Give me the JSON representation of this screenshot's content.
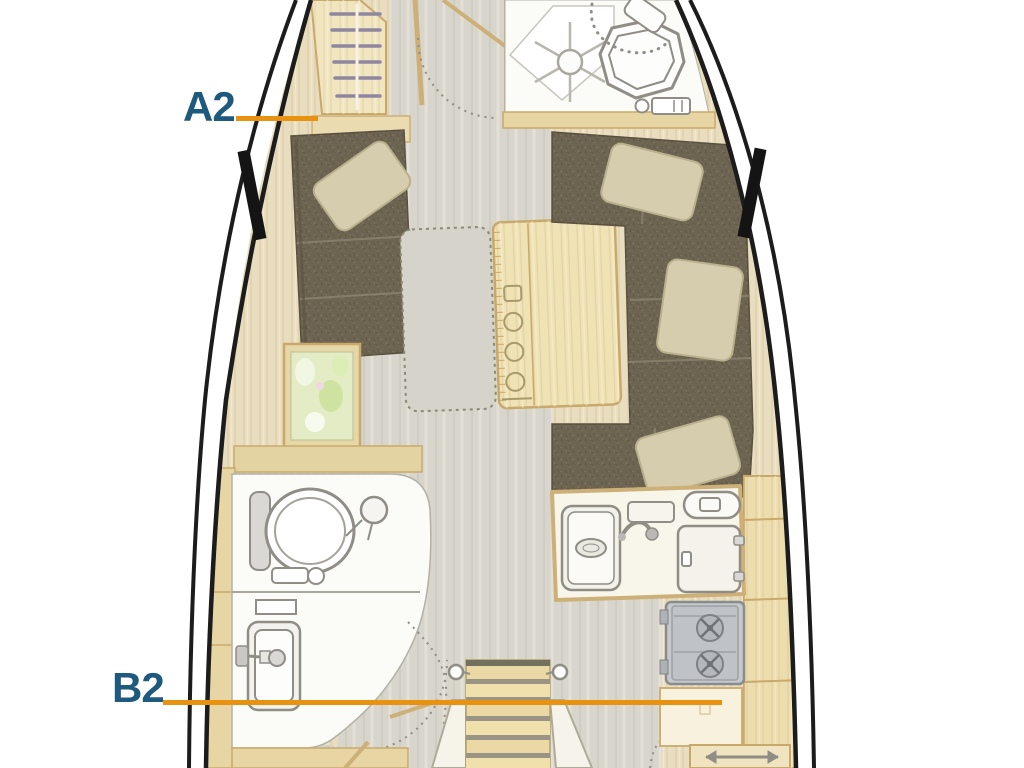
{
  "plan": {
    "type": "sailing-yacht-interior-floorplan",
    "callouts": [
      {
        "id": "a2",
        "label": "A2"
      },
      {
        "id": "b2",
        "label": "B2"
      }
    ],
    "legend_icons": [
      "wardrobe-hangers-icon",
      "shower-icon",
      "toilet-icon",
      "washbasin-icon",
      "saloon-table-icon",
      "settee-icon",
      "pillow-icon",
      "chart-table-icon",
      "galley-sink-icon",
      "fridge-icon",
      "stove-icon",
      "companionway-stairs-icon",
      "door-swing-arc-icon",
      "drawer-slide-arrow-icon"
    ]
  },
  "colors": {
    "label_blue": "#1e5a7e",
    "callout_orange": "#e8920f",
    "hull_black": "#1c1c1c",
    "deck_beige": "#e8ddbe",
    "wood_light": "#f1e5c0",
    "wood_border": "#c9a96b",
    "settee_brown": "#6e6452",
    "pillow_khaki": "#d5cdad",
    "floor_gray": "#d8d5cc",
    "room_white": "#fbfbf8",
    "fixture_gray": "#8f8d86",
    "stove_gray": "#c6c9cc",
    "map_green": "#e3ecc4"
  }
}
